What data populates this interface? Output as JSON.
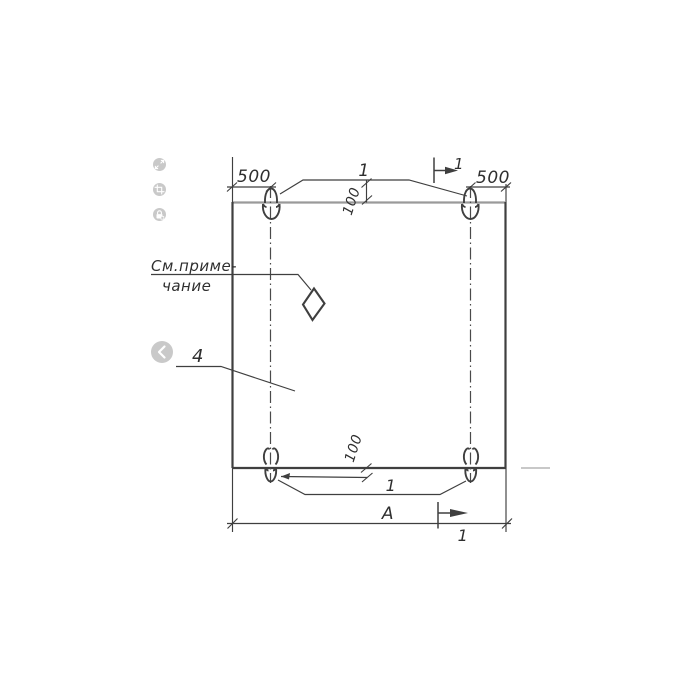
{
  "viewer": {
    "toolbar_buttons": [
      {
        "name": "expand",
        "icon": "expand-icon"
      },
      {
        "name": "crop",
        "icon": "crop-icon"
      },
      {
        "name": "lock",
        "icon": "lock-icon"
      }
    ],
    "nav": {
      "previous": {
        "icon": "chevron-left-icon"
      }
    }
  },
  "drawing": {
    "labels": {
      "dim_500_left": "500",
      "dim_500_right": "500",
      "dim_100_top": "100",
      "dim_100_bottom": "100",
      "loop_callout_top": "1",
      "loop_callout_bottom": "1",
      "section_mark_top": "1",
      "section_mark_bottom": "1",
      "note_line1": "См.приме-",
      "note_line2": "чание",
      "part_callout": "4",
      "overall_width": "А"
    },
    "colors": {
      "ink": "#3f3f3f",
      "edge_light": "#9a9a9a",
      "stub_gray": "#b6b6b6",
      "button_gray": "#c9c9c9"
    }
  }
}
